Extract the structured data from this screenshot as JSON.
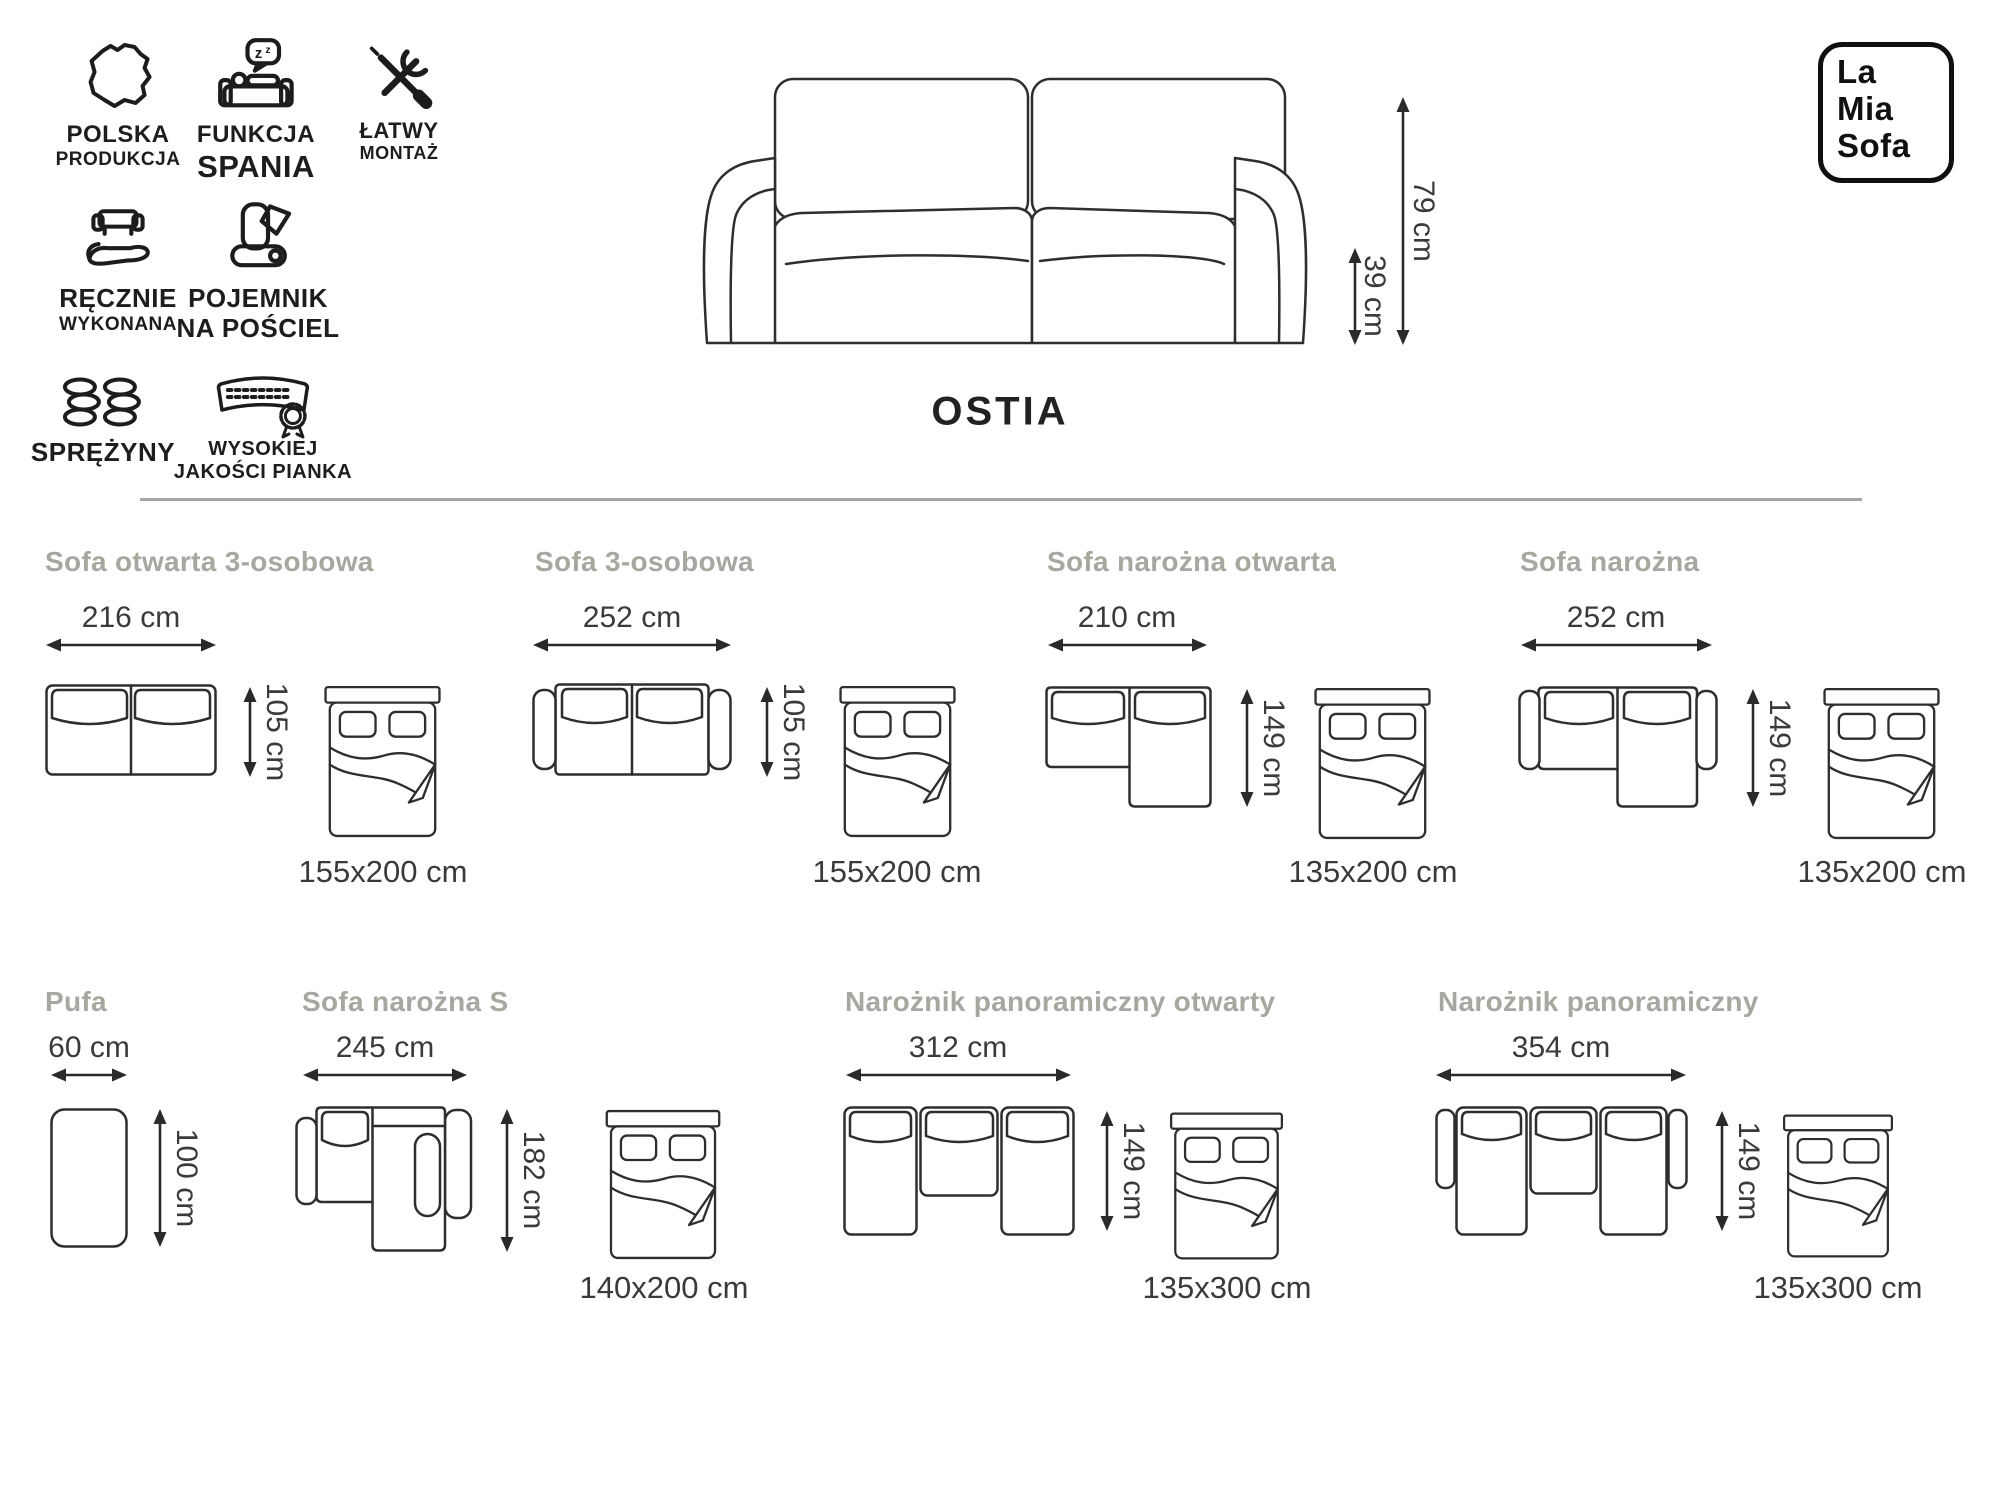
{
  "product": {
    "name": "OSTIA"
  },
  "logo": {
    "line1": "La",
    "line2": "Mia",
    "line3": "Sofa"
  },
  "features": [
    {
      "line1": "POLSKA",
      "line2": "PRODUKCJA"
    },
    {
      "line1": "FUNKCJA",
      "line2": "SPANIA"
    },
    {
      "line1": "ŁATWY",
      "line2": "MONTAŻ"
    },
    {
      "line1": "RĘCZNIE",
      "line2": "WYKONANA"
    },
    {
      "line1": "POJEMNIK",
      "line2": "NA POŚCIEL"
    },
    {
      "line1": "SPRĘŻYNY",
      "line2": ""
    },
    {
      "line1": "WYSOKIEJ",
      "line2": "JAKOŚCI PIANKA"
    }
  ],
  "hero": {
    "total_height": "79 cm",
    "seat_height": "39 cm"
  },
  "configs": [
    {
      "title": "Sofa otwarta 3-osobowa",
      "width": "216 cm",
      "depth": "105 cm",
      "bed_size": "155x200 cm"
    },
    {
      "title": "Sofa 3-osobowa",
      "width": "252 cm",
      "depth": "105 cm",
      "bed_size": "155x200 cm"
    },
    {
      "title": "Sofa narożna otwarta",
      "width": "210 cm",
      "depth": "149 cm",
      "bed_size": "135x200 cm"
    },
    {
      "title": "Sofa narożna",
      "width": "252 cm",
      "depth": "149 cm",
      "bed_size": "135x200 cm"
    },
    {
      "title": "Pufa",
      "width": "60 cm",
      "depth": "100 cm",
      "bed_size": ""
    },
    {
      "title": "Sofa narożna S",
      "width": "245 cm",
      "depth": "182 cm",
      "bed_size": "140x200 cm"
    },
    {
      "title": "Narożnik panoramiczny otwarty",
      "width": "312 cm",
      "depth": "149 cm",
      "bed_size": "135x300 cm"
    },
    {
      "title": "Narożnik panoramiczny",
      "width": "354 cm",
      "depth": "149 cm",
      "bed_size": "135x300 cm"
    }
  ],
  "colors": {
    "title_gray": "#a7a79f",
    "ink": "#2e2e2e"
  }
}
